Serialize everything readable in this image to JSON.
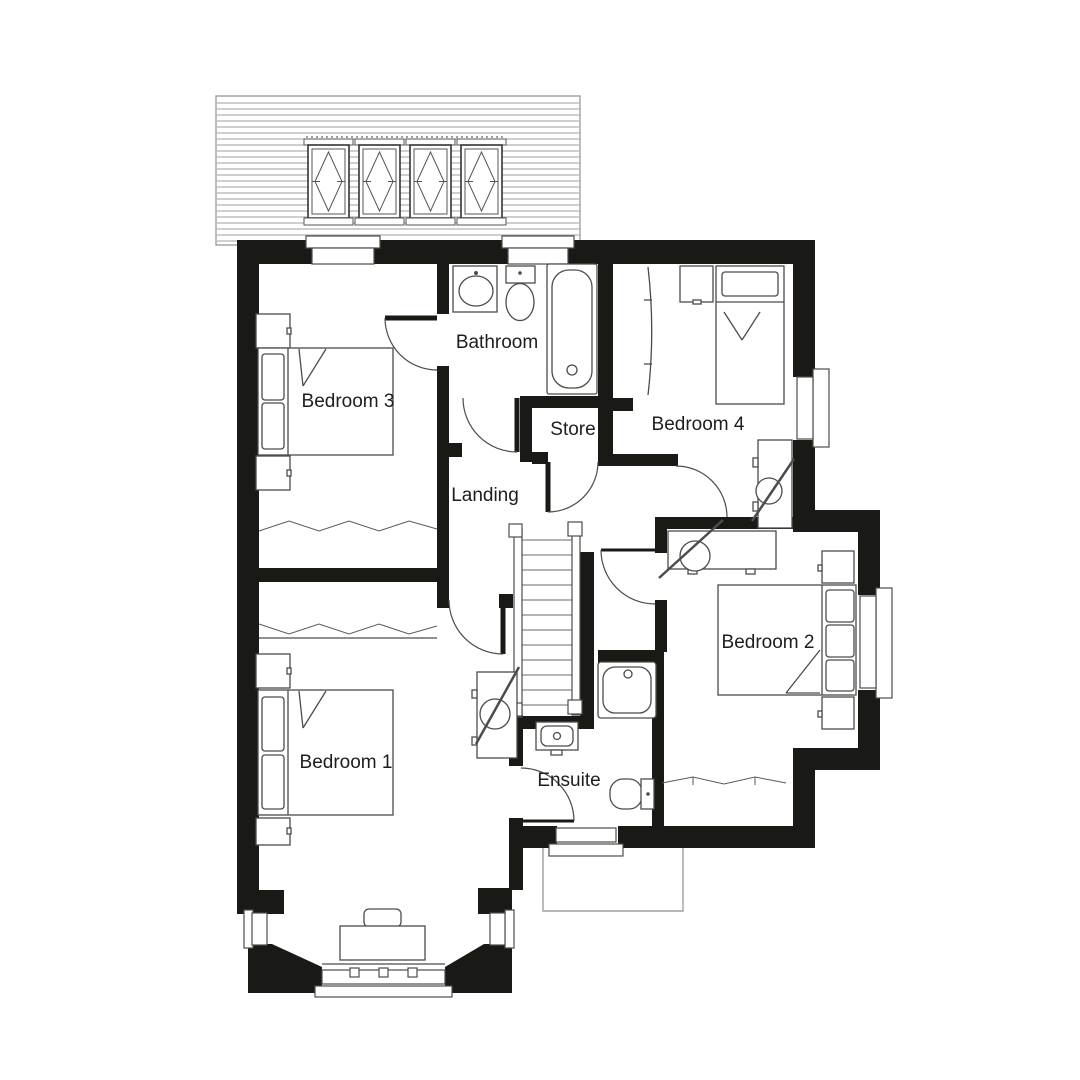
{
  "document": {
    "type": "floor-plan",
    "floor": "first floor"
  },
  "colors": {
    "wall": "#191916",
    "line": "#4c4c4a",
    "label": "#1d1d1d",
    "roof": "#9f9f9d",
    "background": "#ffffff"
  },
  "rooms": [
    {
      "id": "bathroom",
      "label": "Bathroom"
    },
    {
      "id": "bedroom-3",
      "label": "Bedroom 3"
    },
    {
      "id": "bedroom-4",
      "label": "Bedroom 4"
    },
    {
      "id": "store",
      "label": "Store"
    },
    {
      "id": "landing",
      "label": "Landing"
    },
    {
      "id": "bedroom-2",
      "label": "Bedroom 2"
    },
    {
      "id": "bedroom-1",
      "label": "Bedroom 1"
    },
    {
      "id": "ensuite",
      "label": "Ensuite"
    }
  ],
  "dormer": {
    "window_count": 4
  },
  "symbols": [
    "bathtub",
    "bathroom-sink",
    "bathroom-toilet",
    "shower-tray",
    "ensuite-sink",
    "ensuite-toilet",
    "double-bed-bedroom-1",
    "double-bed-bedroom-2",
    "double-bed-bedroom-3",
    "single-bed-bedroom-4",
    "bedside-cabinets",
    "wardrobe-rails",
    "desk-with-chair-bedroom-1",
    "desk-with-chair-bedroom-2",
    "desk-with-chair-bedroom-4",
    "dressing-table-with-stool",
    "staircase",
    "door-swings",
    "window-symbols",
    "bay-window",
    "roof-outline-below"
  ]
}
